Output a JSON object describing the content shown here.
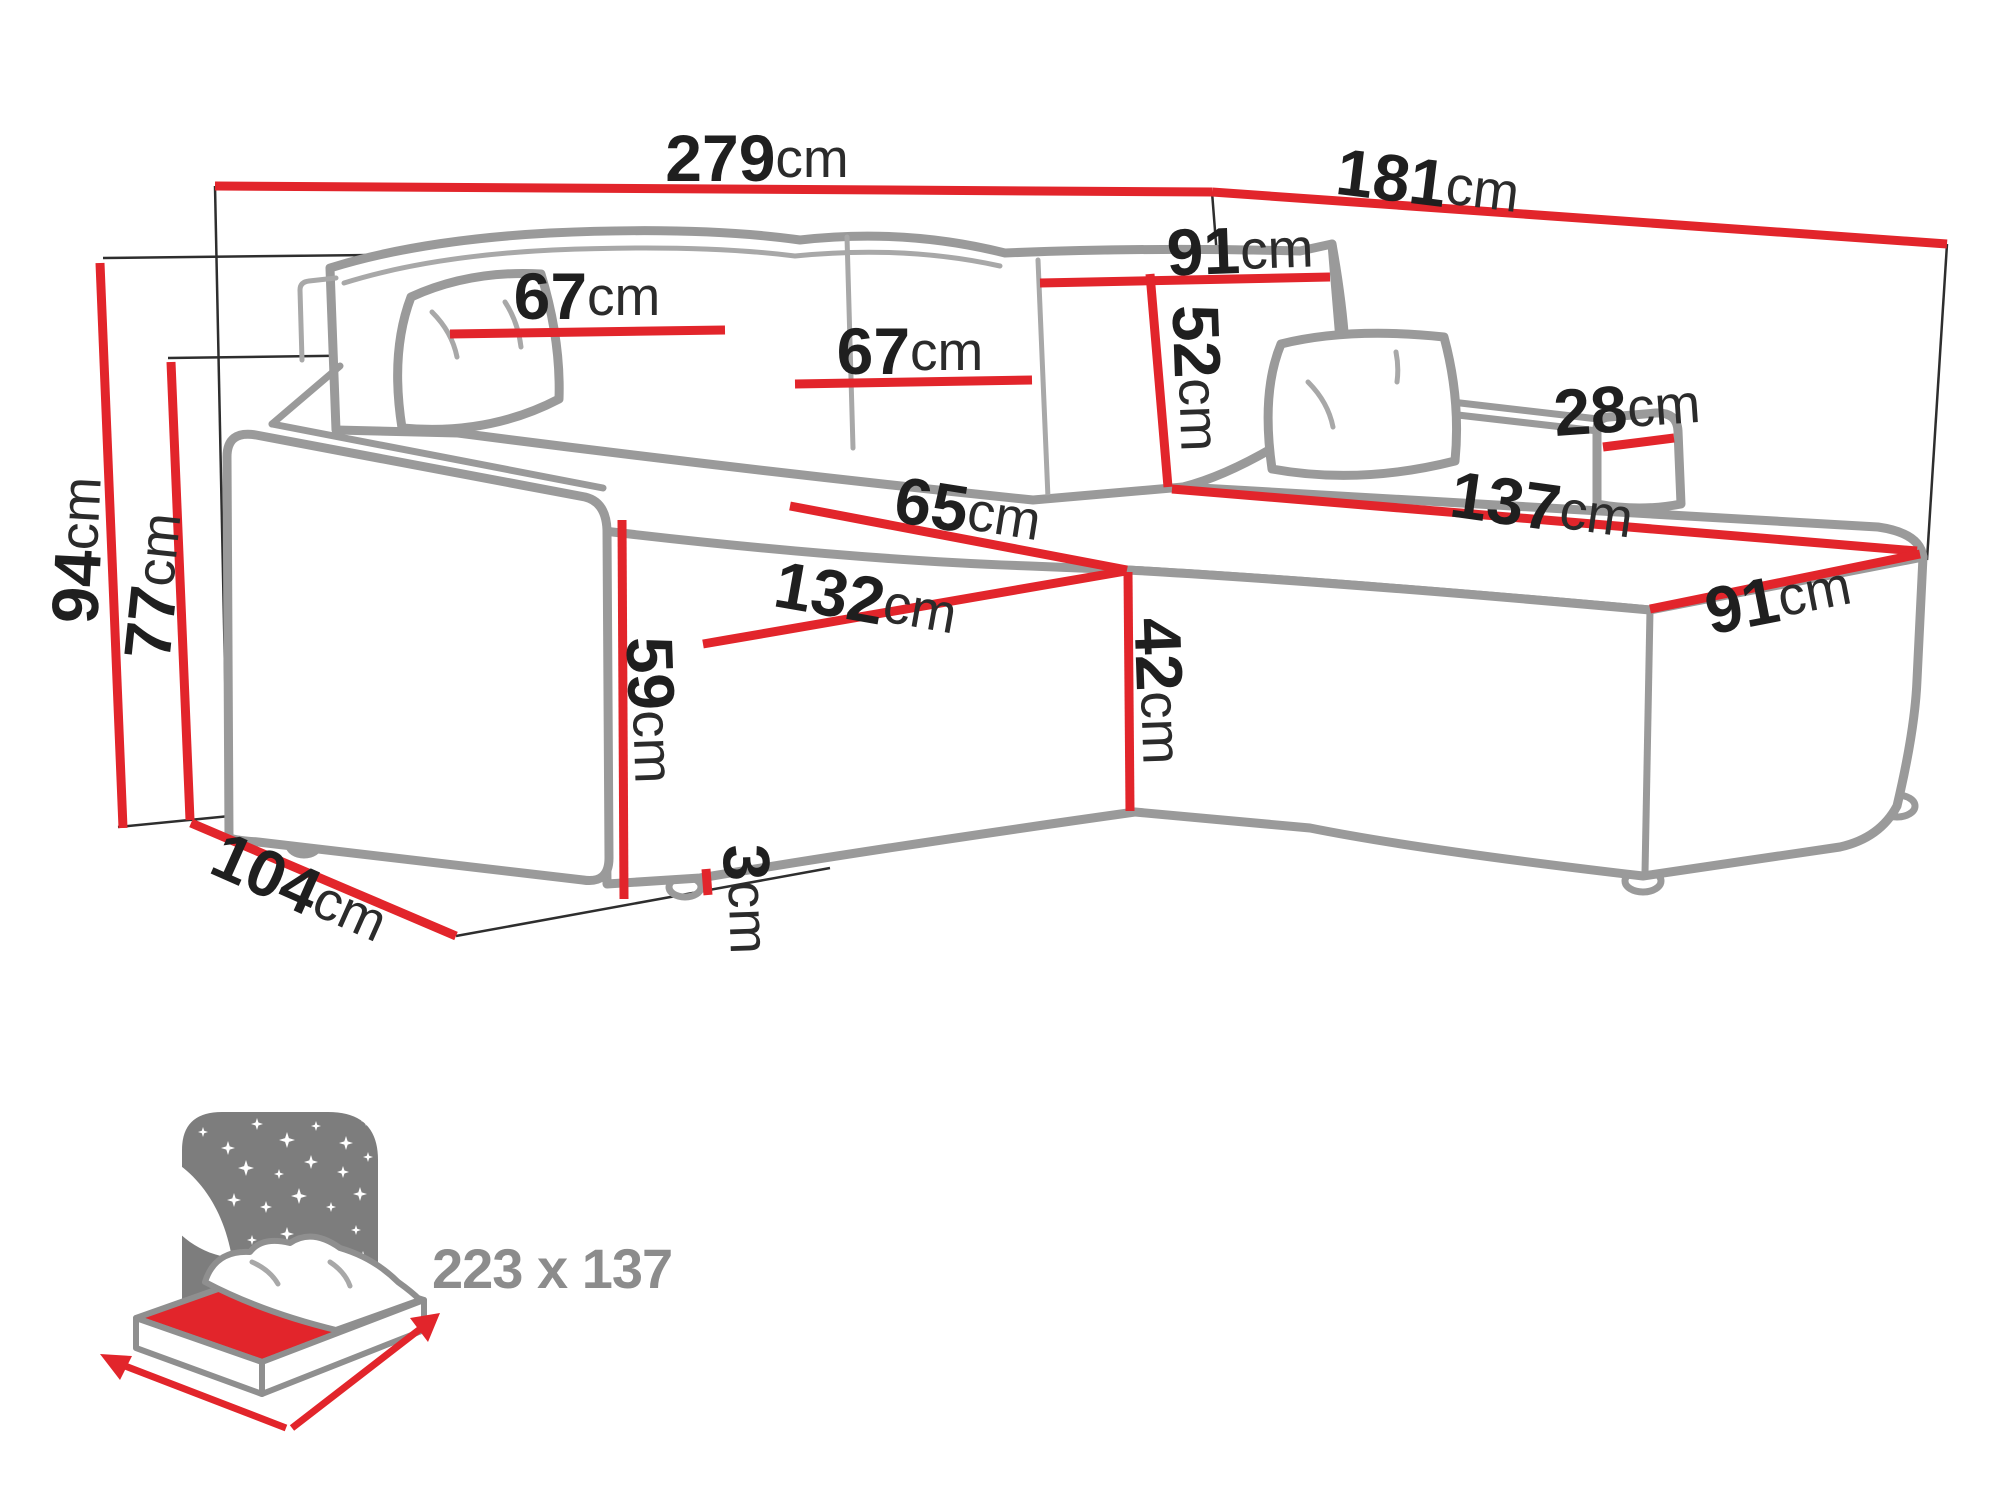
{
  "diagram": {
    "title": "corner-sofa-dimension-diagram",
    "unit": "cm",
    "colors": {
      "dimension_red": "#e2252b",
      "sofa_outline_gray": "#9a9a9a",
      "label_black": "#1f1f1f",
      "icon_gray": "#7d7d7d",
      "icon_text_gray": "#8c8c8c"
    },
    "dims": {
      "d279": {
        "value": "279",
        "suffix": "cm"
      },
      "d181": {
        "value": "181",
        "suffix": "cm"
      },
      "d94": {
        "value": "94",
        "suffix": "cm"
      },
      "d77": {
        "value": "77",
        "suffix": "cm"
      },
      "d104": {
        "value": "104",
        "suffix": "cm"
      },
      "d67_left": {
        "value": "67",
        "suffix": "cm"
      },
      "d67_mid": {
        "value": "67",
        "suffix": "cm"
      },
      "d91_top": {
        "value": "91",
        "suffix": "cm"
      },
      "d52": {
        "value": "52",
        "suffix": "cm"
      },
      "d28": {
        "value": "28",
        "suffix": "cm"
      },
      "d137": {
        "value": "137",
        "suffix": "cm"
      },
      "d91_right": {
        "value": "91",
        "suffix": "cm"
      },
      "d65": {
        "value": "65",
        "suffix": "cm"
      },
      "d132": {
        "value": "132",
        "suffix": "cm"
      },
      "d42": {
        "value": "42",
        "suffix": "cm"
      },
      "d59": {
        "value": "59",
        "suffix": "cm"
      },
      "d3": {
        "value": "3",
        "suffix": "cm"
      }
    },
    "bed_icon": {
      "size_label": "223 x 137"
    }
  }
}
